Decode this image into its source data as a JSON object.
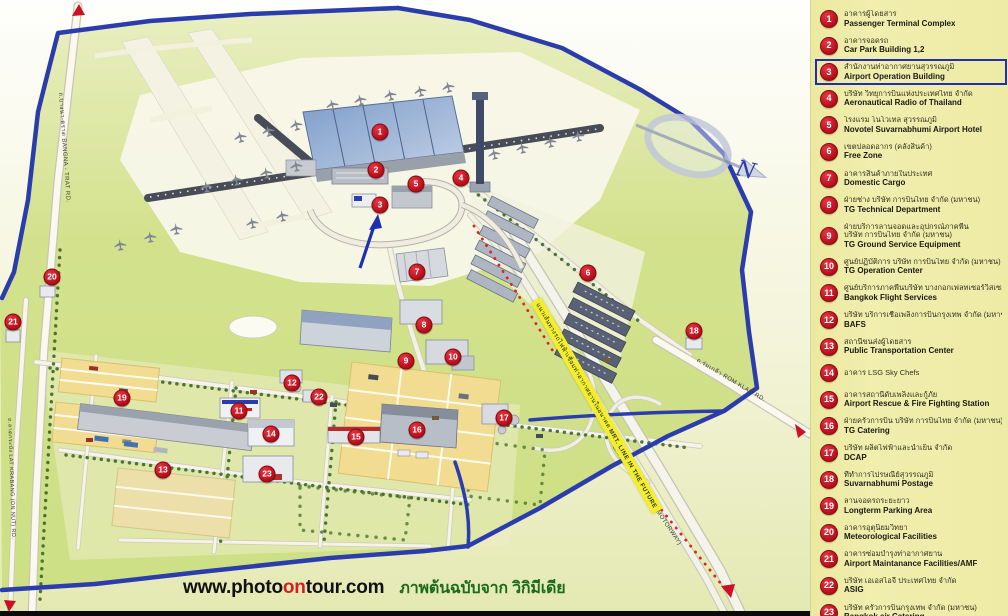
{
  "title": "Suvarnabhumi Airport layout map",
  "credit": {
    "url_part1": "www.photo",
    "url_accent": "on",
    "url_part2": "tour.com",
    "thai_note": "ภาพต้นฉบับจาก วิกิมีเดีย",
    "accent_color": "#d42020",
    "thai_color": "#1c6b1c"
  },
  "legend": {
    "background_color": "#eeeba6",
    "badge_color": "#c4121f",
    "highlight_box_color": "#1f2fb0",
    "items": [
      {
        "n": 1,
        "thai": "อาคารผู้โดยสาร",
        "en": "Passenger Terminal Complex"
      },
      {
        "n": 2,
        "thai": "อาคารจอดรถ",
        "en": "Car Park Building 1,2"
      },
      {
        "n": 3,
        "thai": "สำนักงานท่าอากาศยานสุวรรณภูมิ",
        "en": "Airport Operation Building",
        "highlighted": true
      },
      {
        "n": 4,
        "thai": "บริษัท วิทยุการบินแห่งประเทศไทย จำกัด",
        "en": "Aeronautical Radio of Thailand"
      },
      {
        "n": 5,
        "thai": "โรงแรม โนโวเทล สุวรรณภูมิ",
        "en": "Novotel Suvarnabhumi Airport Hotel"
      },
      {
        "n": 6,
        "thai": "เขตปลอดอากร (คลังสินค้า)",
        "en": "Free Zone"
      },
      {
        "n": 7,
        "thai": "อาคารสินค้าภายในประเทศ",
        "en": "Domestic Cargo"
      },
      {
        "n": 8,
        "thai": "ฝ่ายช่าง บริษัท การบินไทย จำกัด (มหาชน)",
        "en": "TG Technical Department"
      },
      {
        "n": 9,
        "thai": "ฝ่ายบริการลานจอดและอุปกรณ์ภาคพื้น",
        "thai2": "บริษัท การบินไทย จำกัด (มหาชน)",
        "en": "TG Ground Service Equipment"
      },
      {
        "n": 10,
        "thai": "ศูนย์ปฏิบัติการ บริษัท การบินไทย จำกัด (มหาชน)",
        "en": "TG Operation Center"
      },
      {
        "n": 11,
        "thai": "ศูนย์บริการภาคพื้นบริษัท บางกอกเฟลทเซอร์วิสเซส",
        "en": "Bangkok Flight Services"
      },
      {
        "n": 12,
        "thai": "บริษัท บริการเชื้อเพลิงการบินกรุงเทพ จำกัด (มหาชน)",
        "en": "BAFS"
      },
      {
        "n": 13,
        "thai": "สถานีขนส่งผู้โดยสาร",
        "en": "Public Transportation Center"
      },
      {
        "n": 14,
        "thai": "อาคาร LSG  Sky Chefs",
        "en": ""
      },
      {
        "n": 15,
        "thai": "อาคารสถานีดับเพลิงและกู้ภัย",
        "en": "Airport Rescue & Fire Fighting Station"
      },
      {
        "n": 16,
        "thai": "ฝ่ายครัวการบิน บริษัท การบินไทย จำกัด (มหาชน)",
        "en": "TG Catering"
      },
      {
        "n": 17,
        "thai": "บริษัท ผลิตไฟฟ้าและน้ำเย็น จำกัด",
        "en": "DCAP"
      },
      {
        "n": 18,
        "thai": "ที่ทำการไปรษณีย์สุวรรณภูมิ",
        "en": "Suvarnabhumi Postage"
      },
      {
        "n": 19,
        "thai": "ลานจอดรถระยะยาว",
        "en": "Longterm Parking Area"
      },
      {
        "n": 20,
        "thai": "อาคารอุตุนิยมวิทยา",
        "en": "Meteorological Facilities"
      },
      {
        "n": 21,
        "thai": "อาคารซ่อมบำรุงท่าอากาศยาน",
        "en": "Airport Maintanance Facilities/AMF"
      },
      {
        "n": 22,
        "thai": "บริษัท เอเอสไอจี ประเทศไทย จำกัด",
        "en": "ASIG"
      },
      {
        "n": 23,
        "thai": "บริษัท ครัวการบินกรุงเทพ จำกัด (มหาชน)",
        "en": "Bangkok air Catering"
      }
    ]
  },
  "map": {
    "boundary_color": "#2b3cad",
    "markers": [
      {
        "n": 1,
        "x": 380,
        "y": 132
      },
      {
        "n": 2,
        "x": 376,
        "y": 170
      },
      {
        "n": 3,
        "x": 380,
        "y": 205
      },
      {
        "n": 4,
        "x": 461,
        "y": 178
      },
      {
        "n": 5,
        "x": 416,
        "y": 184
      },
      {
        "n": 6,
        "x": 588,
        "y": 273
      },
      {
        "n": 7,
        "x": 417,
        "y": 272
      },
      {
        "n": 8,
        "x": 424,
        "y": 325
      },
      {
        "n": 9,
        "x": 406,
        "y": 361
      },
      {
        "n": 10,
        "x": 453,
        "y": 357
      },
      {
        "n": 11,
        "x": 239,
        "y": 411
      },
      {
        "n": 12,
        "x": 292,
        "y": 383
      },
      {
        "n": 13,
        "x": 163,
        "y": 470
      },
      {
        "n": 14,
        "x": 271,
        "y": 434
      },
      {
        "n": 15,
        "x": 356,
        "y": 437
      },
      {
        "n": 16,
        "x": 417,
        "y": 430
      },
      {
        "n": 17,
        "x": 504,
        "y": 418
      },
      {
        "n": 18,
        "x": 694,
        "y": 331
      },
      {
        "n": 19,
        "x": 122,
        "y": 398
      },
      {
        "n": 20,
        "x": 52,
        "y": 277
      },
      {
        "n": 21,
        "x": 13,
        "y": 322
      },
      {
        "n": 22,
        "x": 319,
        "y": 397
      },
      {
        "n": 23,
        "x": 267,
        "y": 474
      }
    ],
    "labels": {
      "bangna_trat_road": "ถ.บางนา-ตราด  BANGNA - TRAT RD.",
      "lat_krabang_road": "ถ.ลาดกระบัง  LAT KRABANG (ON NUT) RD.",
      "rom_klao_road": "ถ.ร่มเกล้า  ROM KLAO RD.",
      "motorway_road": "BANGKOK - CHOLBURI (MOTORWAY)",
      "mrt_line_thai": "แนวเส้นทางรถไฟฟ้าเชื่อมท่าอากาศยานในอนาคต",
      "mrt_line_en": "MRT. LINE IN THE FUTURE",
      "compass_north": "N"
    }
  }
}
